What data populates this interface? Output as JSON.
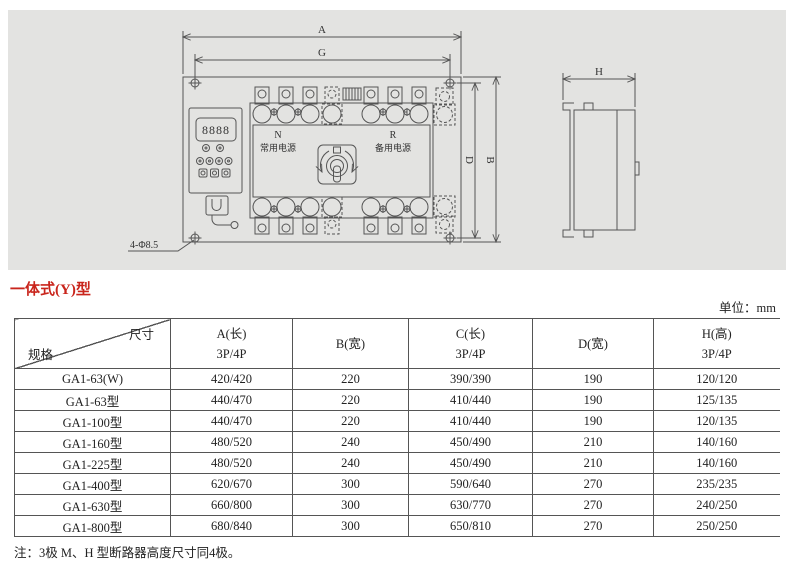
{
  "page": {
    "heading": "一体式(Y)型",
    "unit_label": "单位：mm",
    "note": "注：3极 M、H 型断路器高度尺寸同4极。"
  },
  "drawing": {
    "dims": {
      "a": "A",
      "g": "G",
      "b": "B",
      "d": "D",
      "h": "H"
    },
    "holes_label": "4-Φ8.5",
    "display_value": "8888",
    "normal_code": "N",
    "normal_name": "常用电源",
    "reserve_code": "R",
    "reserve_name": "备用电源"
  },
  "table": {
    "corner": {
      "top_right": "尺寸",
      "bottom_left": "规格"
    },
    "columns": [
      {
        "line1": "A(长)",
        "line2": "3P/4P"
      },
      {
        "line1": "B(宽)",
        "line2": ""
      },
      {
        "line1": "C(长)",
        "line2": "3P/4P"
      },
      {
        "line1": "D(宽)",
        "line2": ""
      },
      {
        "line1": "H(高)",
        "line2": "3P/4P"
      }
    ],
    "rows": [
      {
        "model": "GA1-63(W)",
        "a": "420/420",
        "b": "220",
        "c": "390/390",
        "d": "190",
        "h": "120/120"
      },
      {
        "model": "GA1-63型",
        "a": "440/470",
        "b": "220",
        "c": "410/440",
        "d": "190",
        "h": "125/135"
      },
      {
        "model": "GA1-100型",
        "a": "440/470",
        "b": "220",
        "c": "410/440",
        "d": "190",
        "h": "120/135"
      },
      {
        "model": "GA1-160型",
        "a": "480/520",
        "b": "240",
        "c": "450/490",
        "d": "210",
        "h": "140/160"
      },
      {
        "model": "GA1-225型",
        "a": "480/520",
        "b": "240",
        "c": "450/490",
        "d": "210",
        "h": "140/160"
      },
      {
        "model": "GA1-400型",
        "a": "620/670",
        "b": "300",
        "c": "590/640",
        "d": "270",
        "h": "235/235"
      },
      {
        "model": "GA1-630型",
        "a": "660/800",
        "b": "300",
        "c": "630/770",
        "d": "270",
        "h": "240/250"
      },
      {
        "model": "GA1-800型",
        "a": "680/840",
        "b": "300",
        "c": "650/810",
        "d": "270",
        "h": "250/250"
      }
    ]
  },
  "colors": {
    "accent_red": "#c9251c",
    "panel_bg": "#e3e3e1",
    "line": "#555555"
  }
}
